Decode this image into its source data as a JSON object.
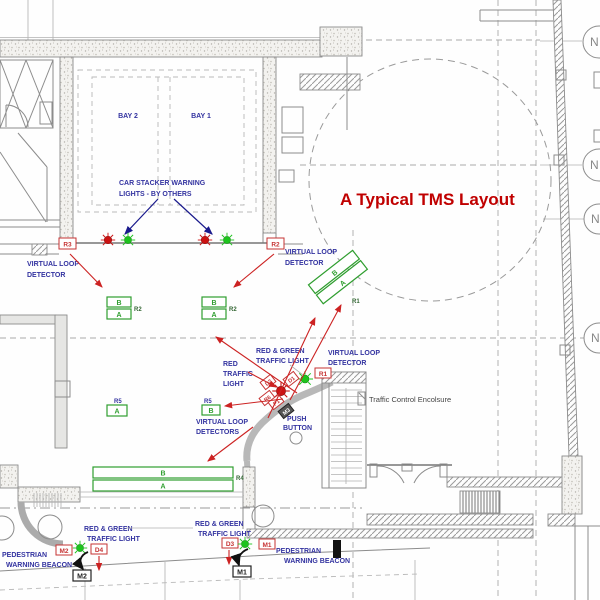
{
  "title": "A Typical TMS Layout",
  "colors": {
    "title_red": "#c00000",
    "annotation_blue": "#3333a0",
    "tag_red": "#c63333",
    "loop_green": "#2f9e2f",
    "light_red": "#cc1111",
    "light_green": "#1dc41d"
  },
  "bays": {
    "bay2": "BAY 2",
    "bay1": "BAY 1"
  },
  "notes": {
    "car_stacker_l1": "CAR STACKER WARNING",
    "car_stacker_l2": "LIGHTS - BY OTHERS",
    "vld_l1": "VIRTUAL LOOP",
    "vld_l2": "DETECTOR",
    "vlds_l2": "DETECTORS",
    "red_l1": "RED",
    "red_l2": "TRAFFIC",
    "red_l3": "LIGHT",
    "rg_l1": "RED & GREEN",
    "rg_l2": "TRAFFIC LIGHT",
    "push_l1": "PUSH",
    "push_l2": "BUTTON",
    "enclosure": "Traffic Control Encolsure",
    "ped_l1": "PEDESTRIAN",
    "ped_l2": "WARNING BEACON"
  },
  "tags": {
    "r3": "R3",
    "r2": "R2",
    "r1": "R1",
    "d4": "D4",
    "d3": "D3",
    "m2": "M2",
    "m1": "M1"
  },
  "refs": {
    "m2": "M2",
    "m1": "M1"
  },
  "cluster_tags": {
    "t1": "D2",
    "t2": "D1",
    "t3": "R6",
    "t4": "P1",
    "t5": "M3"
  },
  "loops": {
    "mid_left": {
      "top": "B",
      "bottom": "A",
      "ref": "R2"
    },
    "mid_right": {
      "top": "B",
      "bottom": "A",
      "ref": "R2"
    },
    "angled": {
      "top": "B",
      "bottom": "A",
      "ref": "R1"
    },
    "long": {
      "top": "B",
      "bottom": "A",
      "ref": "R4"
    },
    "single_left": {
      "ref": "R5",
      "letter": "A"
    },
    "single_right": {
      "ref": "R5",
      "letter": "B"
    }
  },
  "grid": {
    "bubble": "N"
  }
}
